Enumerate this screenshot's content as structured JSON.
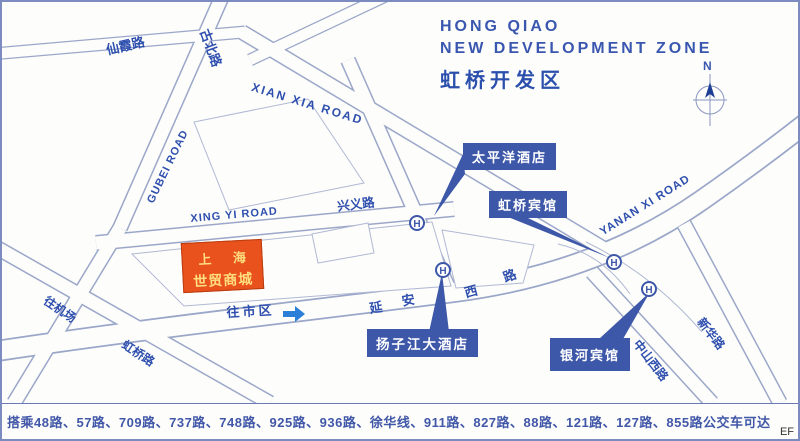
{
  "title": {
    "line1": "HONG QIAO",
    "line2": "NEW DEVELOPMENT ZONE",
    "line3": "虹桥开发区"
  },
  "compass": {
    "north_label": "N"
  },
  "roads": {
    "xianxia_cn": "仙霞路",
    "gubei_cn": "古北路",
    "gubei_en": "GUBEI ROAD",
    "xianxia_en": "XIAN XIA ROAD",
    "xingyi_en": "XING YI ROAD",
    "xingyi_cn": "兴义路",
    "yanan_en": "YANAN XI ROAD",
    "yanan_cn": [
      "延",
      "安",
      "西",
      "路"
    ],
    "zhongshan_cn": "中山西路",
    "xinhua_cn": "新华路",
    "hongqiao_cn": "虹桥路"
  },
  "directions": {
    "to_airport": "往机场",
    "to_city": "往市区"
  },
  "landmark": {
    "name_line1": "上 海",
    "name_line2": "世贸商城"
  },
  "hotels": [
    {
      "name": "太平洋酒店"
    },
    {
      "name": "虹桥宾馆"
    },
    {
      "name": "扬子江大酒店"
    },
    {
      "name": "银河宾馆"
    }
  ],
  "markers": {
    "hotel_symbol": "H"
  },
  "footer": {
    "bus_routes": "搭乘48路、57路、709路、737路、748路、925路、936路、徐华线、911路、827路、88路、121路、127路、855路公交车可达",
    "corner_mark": "EF"
  },
  "colors": {
    "label_bg": "#3d57a9",
    "road_line": "#9ba7c9",
    "landmark_bg": "#e9521d",
    "landmark_text": "#ffdf7e",
    "text_blue": "#2e4fae",
    "arrow_blue": "#2b7fd8"
  }
}
